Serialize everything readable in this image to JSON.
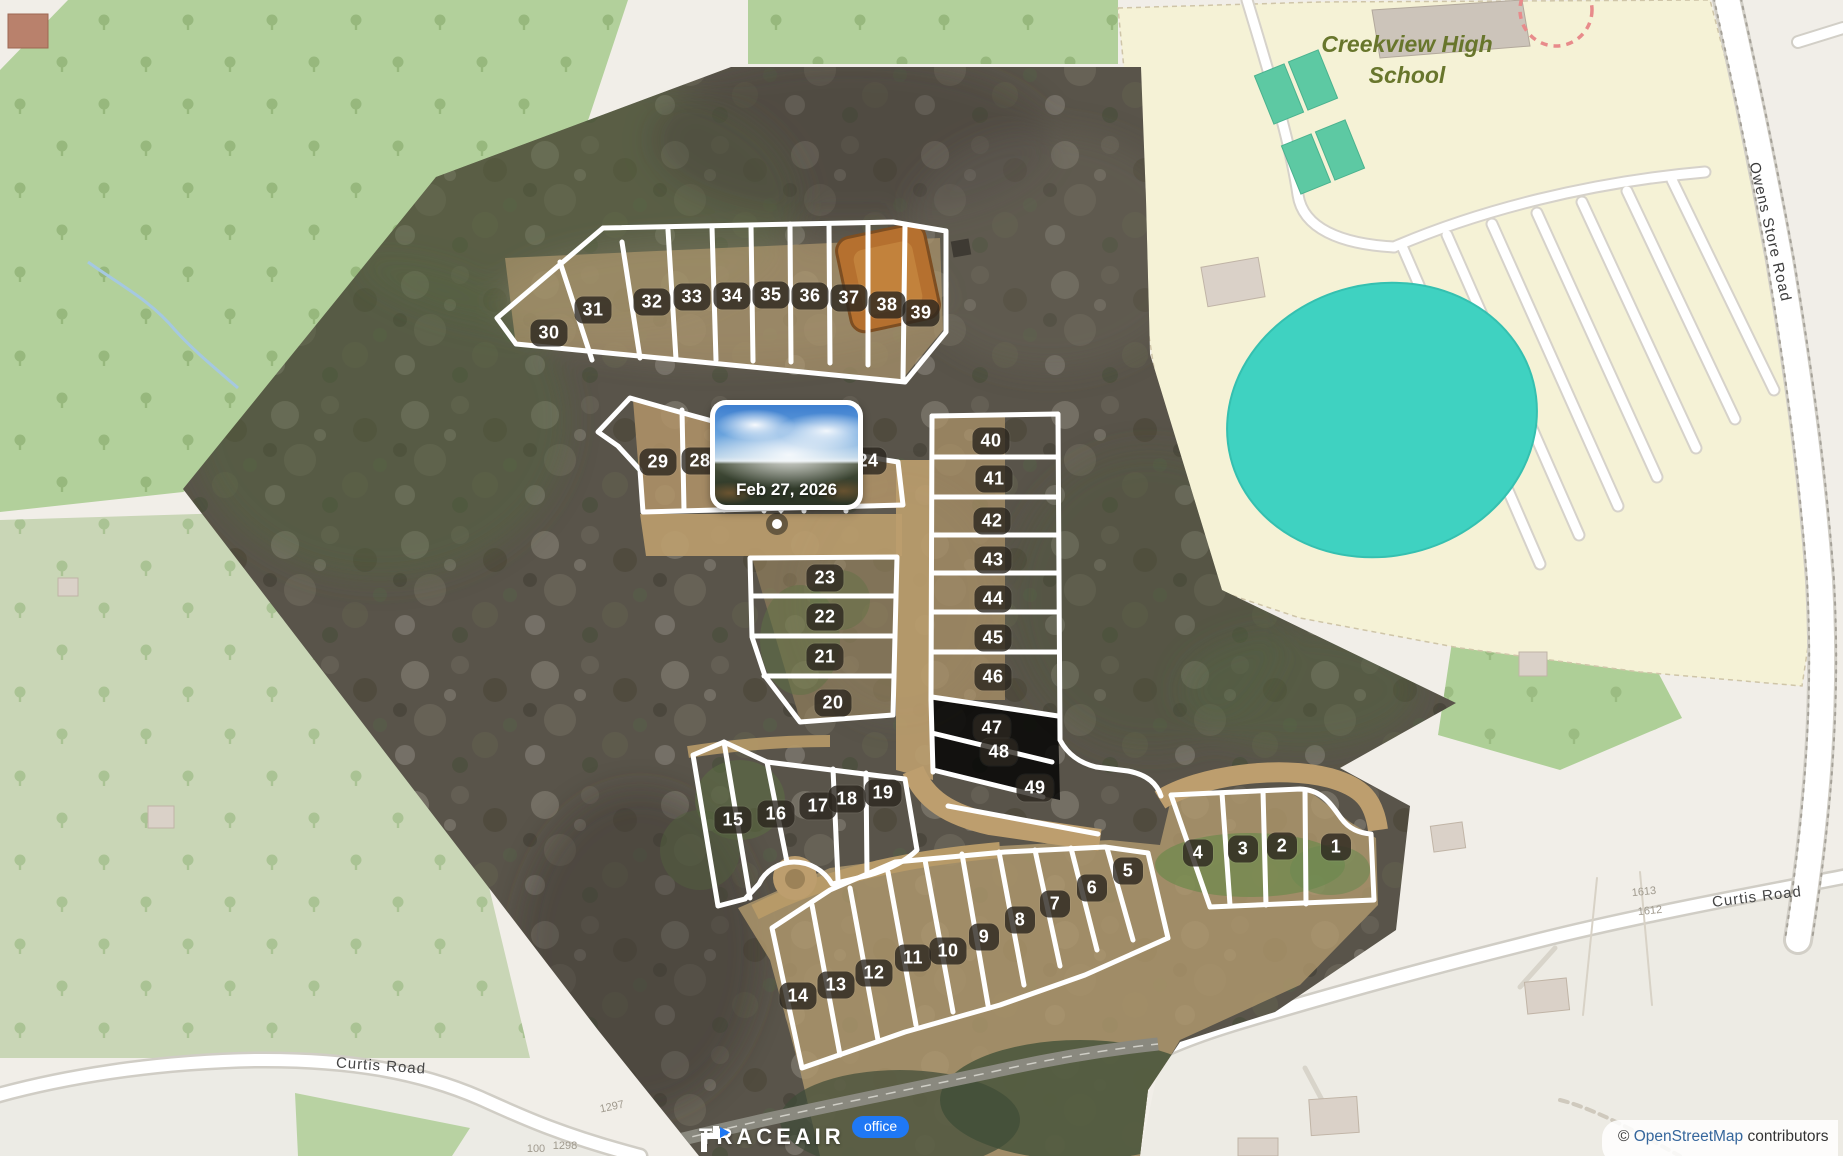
{
  "popup": {
    "date": "Feb 27, 2026"
  },
  "branding": {
    "logo_text": "TRACEAIR",
    "badge": "office"
  },
  "attribution": {
    "prefix": "© ",
    "link_text": "OpenStreetMap",
    "suffix": " contributors"
  },
  "map_labels": {
    "school": "Creekview High School",
    "owens_store_road": "Owens Store Road",
    "curtis_left": "Curtis Road",
    "curtis_right": "Curtis Road"
  },
  "house_numbers": [
    {
      "text": "1613",
      "x": 1644,
      "y": 892,
      "rot": -6
    },
    {
      "text": "1612",
      "x": 1650,
      "y": 911,
      "rot": -6
    },
    {
      "text": "1297",
      "x": 612,
      "y": 1107,
      "rot": -12
    },
    {
      "text": "1298",
      "x": 565,
      "y": 1146,
      "rot": 0
    },
    {
      "text": "100",
      "x": 536,
      "y": 1149,
      "rot": 0
    }
  ],
  "lots": [
    {
      "n": "30",
      "x": 549,
      "y": 333
    },
    {
      "n": "31",
      "x": 593,
      "y": 310
    },
    {
      "n": "32",
      "x": 652,
      "y": 302
    },
    {
      "n": "33",
      "x": 692,
      "y": 297
    },
    {
      "n": "34",
      "x": 732,
      "y": 296
    },
    {
      "n": "35",
      "x": 771,
      "y": 295
    },
    {
      "n": "36",
      "x": 810,
      "y": 296
    },
    {
      "n": "37",
      "x": 849,
      "y": 298
    },
    {
      "n": "38",
      "x": 887,
      "y": 305
    },
    {
      "n": "39",
      "x": 921,
      "y": 313
    },
    {
      "n": "29",
      "x": 658,
      "y": 462
    },
    {
      "n": "28",
      "x": 700,
      "y": 461
    },
    {
      "n": "24",
      "x": 868,
      "y": 461
    },
    {
      "n": "40",
      "x": 991,
      "y": 441
    },
    {
      "n": "41",
      "x": 994,
      "y": 479
    },
    {
      "n": "42",
      "x": 992,
      "y": 521
    },
    {
      "n": "43",
      "x": 993,
      "y": 560
    },
    {
      "n": "44",
      "x": 993,
      "y": 599
    },
    {
      "n": "45",
      "x": 993,
      "y": 638
    },
    {
      "n": "46",
      "x": 993,
      "y": 677
    },
    {
      "n": "47",
      "x": 992,
      "y": 728
    },
    {
      "n": "48",
      "x": 999,
      "y": 752
    },
    {
      "n": "49",
      "x": 1035,
      "y": 788
    },
    {
      "n": "23",
      "x": 825,
      "y": 578
    },
    {
      "n": "22",
      "x": 825,
      "y": 617
    },
    {
      "n": "21",
      "x": 825,
      "y": 657
    },
    {
      "n": "20",
      "x": 833,
      "y": 703
    },
    {
      "n": "15",
      "x": 733,
      "y": 820
    },
    {
      "n": "16",
      "x": 776,
      "y": 814
    },
    {
      "n": "17",
      "x": 818,
      "y": 806
    },
    {
      "n": "18",
      "x": 847,
      "y": 799
    },
    {
      "n": "19",
      "x": 883,
      "y": 793
    },
    {
      "n": "14",
      "x": 798,
      "y": 996
    },
    {
      "n": "13",
      "x": 836,
      "y": 985
    },
    {
      "n": "12",
      "x": 874,
      "y": 973
    },
    {
      "n": "11",
      "x": 913,
      "y": 958
    },
    {
      "n": "10",
      "x": 948,
      "y": 951
    },
    {
      "n": "9",
      "x": 984,
      "y": 937
    },
    {
      "n": "8",
      "x": 1020,
      "y": 920
    },
    {
      "n": "7",
      "x": 1055,
      "y": 904
    },
    {
      "n": "6",
      "x": 1092,
      "y": 888
    },
    {
      "n": "5",
      "x": 1128,
      "y": 871
    },
    {
      "n": "4",
      "x": 1198,
      "y": 853
    },
    {
      "n": "3",
      "x": 1243,
      "y": 849
    },
    {
      "n": "2",
      "x": 1282,
      "y": 846
    },
    {
      "n": "1",
      "x": 1336,
      "y": 847
    }
  ],
  "colors": {
    "accent_blue": "#1f78f5",
    "lot_label_bg": "rgba(44,39,31,0.8)",
    "forest_green": "#b2d09b",
    "campus_yellow": "#f5f2d6",
    "pitch_teal": "#3fd2c1",
    "dirt_tan": "#b99c6c"
  }
}
